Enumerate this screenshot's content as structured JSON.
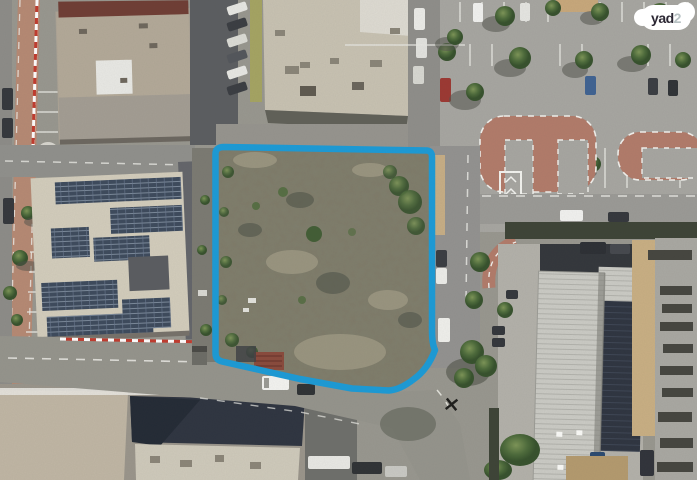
{
  "brand": {
    "name": "yad2",
    "logo": {
      "primary": "yad",
      "accent": "2"
    }
  },
  "map": {
    "kind": "aerial-photo",
    "parcel": {
      "outline_color": "#1b9bd7",
      "content": "vacant-scrubland-lot"
    },
    "marker": {
      "symbol": "×",
      "color": "#1d1d1b"
    }
  },
  "palette": {
    "asphalt": "#98978f",
    "parking_asphalt": "#a7a6a1",
    "brick_island": "#b27b6a",
    "red_street": "#b98a74",
    "roof_tan": "#c8c2b2",
    "roof_maroon": "#6f3d34",
    "solar_panel": "#3d4a5c",
    "warehouse_roof": "#cbcbc5",
    "tree_green": "#4c6a3a",
    "scrub_base": "#7f7b69",
    "sand": "#c9af83",
    "curb_red": "#c23b2e",
    "line_white": "#efefea"
  }
}
